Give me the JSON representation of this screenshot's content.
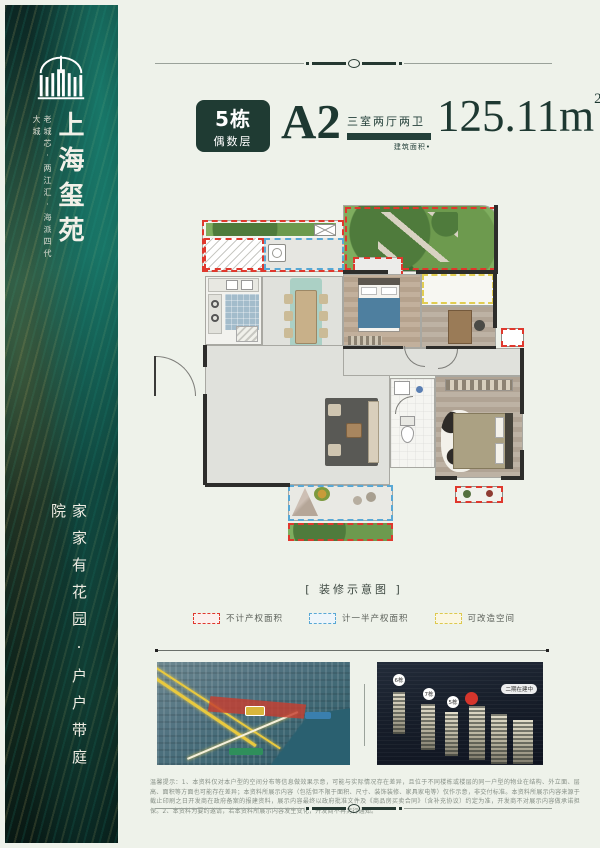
{
  "colors": {
    "accent_green": "#1f3b33",
    "overlay_red": "#df382d",
    "overlay_blue": "#58a8d5",
    "overlay_yellow": "#e1cd52",
    "page_bg": "#eef2ea"
  },
  "sidebar": {
    "brand": "上海玺苑",
    "tagline": "老城芯·两江汇·海派四代大城",
    "slogan": "家家有花园·户户带庭院",
    "logo_icon": "arch-gate-icon"
  },
  "header": {
    "badge_building": "5栋",
    "badge_floor": "偶数层",
    "unit": "A2",
    "rooms": "三室两厅两卫",
    "area_label": "建筑面积•",
    "area_value": "125.11",
    "area_unit": "m",
    "area_sup": "2"
  },
  "plan": {
    "caption": "[ 装修示意图 ]"
  },
  "legend": {
    "items": [
      {
        "label": "不计产权面积",
        "color": "#df382d"
      },
      {
        "label": "计一半产权面积",
        "color": "#58a8d5"
      },
      {
        "label": "可改造空间",
        "color": "#e1cd52"
      }
    ]
  },
  "photos": {
    "right": {
      "tower_labels": [
        "6栋",
        "7栋",
        "5栋"
      ],
      "status_tag": "二期在建中"
    }
  },
  "disclaimer": {
    "text": "温馨提示：1、本资料仅对本户型的空间分布等信息做效果示意，可能与实际情况存在差异，且位于不同楼栋或楼层的同一户型的物业在结构、外立面、层高、面积等方面也可能存在差异；本资料所展示内容（包括但不限于面积、尺寸、装饰装修、家具家电等）仅作示意，非交付标准。本资料所展示内容来源于截止印刷之日开发商在政府备案的报建资料，展示内容最终以政府批准文件及《商品房买卖合同》（含补充协议）约定为准，开发商不对展示内容做承诺担保。2、本资料为要约邀请，若本资料所展示内容发生变化，开发商不再另行通知。"
  }
}
